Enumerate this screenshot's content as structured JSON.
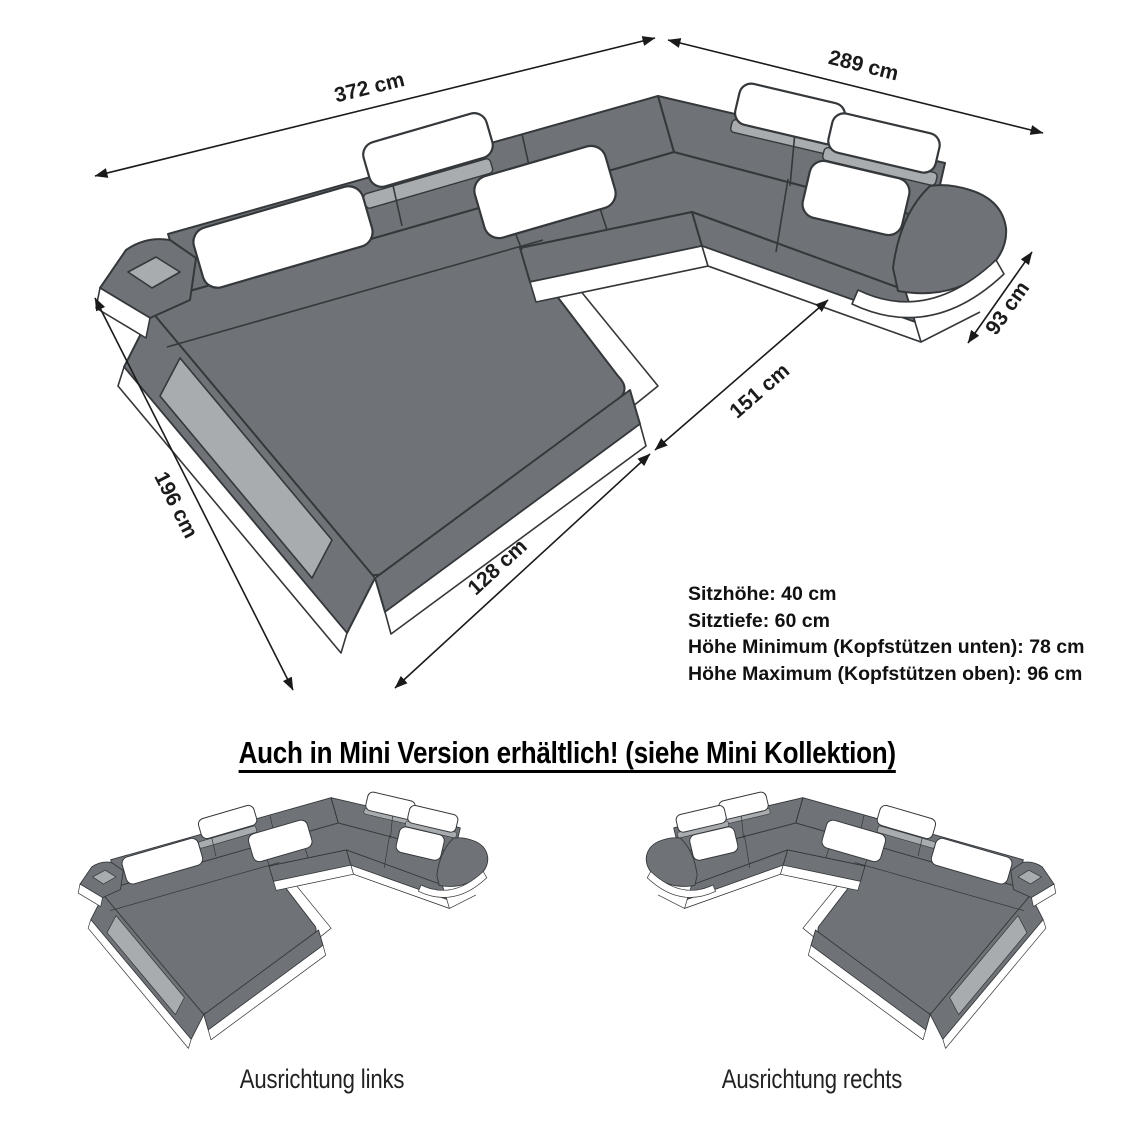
{
  "diagram": {
    "dimensions": {
      "back_width": "372 cm",
      "right_width": "289 cm",
      "right_arm_depth": "93 cm",
      "inner_width": "151 cm",
      "left_depth": "196 cm",
      "chaise_width": "128 cm"
    },
    "specs": [
      "Sitzhöhe: 40 cm",
      "Sitztiefe: 60 cm",
      "Höhe Minimum (Kopfstützen unten): 78 cm",
      "Höhe Maximum (Kopfstützen oben): 96 cm"
    ],
    "mini_heading": "Auch in Mini Version erhältlich! (siehe Mini Kollektion)",
    "orientation_labels": {
      "left": "Ausrichtung links",
      "right": "Ausrichtung rechts"
    },
    "colors": {
      "sofa_gray": "#6f7377",
      "panel_light": "#a9acaf",
      "outline": "#35383b",
      "dimension_line": "#1a1a1a",
      "pillow": "#ffffff"
    }
  }
}
